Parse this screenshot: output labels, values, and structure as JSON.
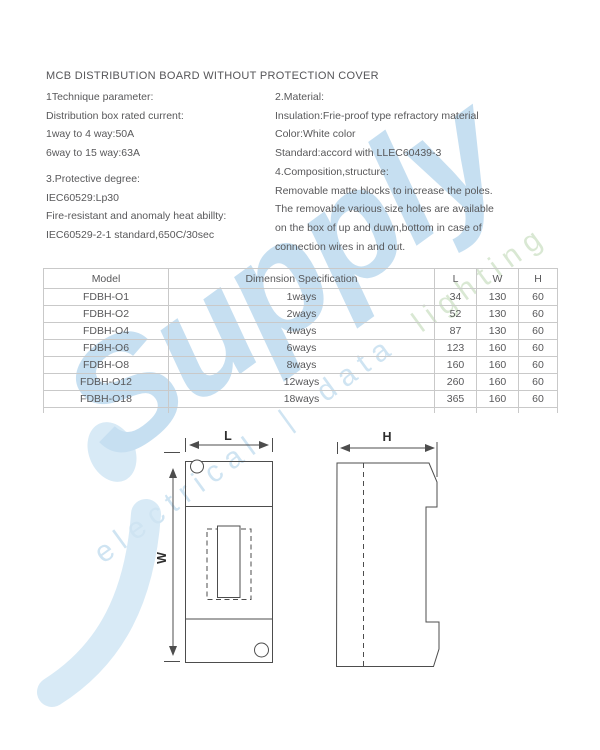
{
  "page": {
    "title": "MCB DISTRIBUTION BOARD WITHOUT PROTECTION COVER"
  },
  "sections": {
    "technique": {
      "heading": "1Technique parameter:",
      "lines": [
        "Distribution box rated current:",
        "1way to 4 way:50A",
        "6way to 15 way:63A"
      ]
    },
    "material": {
      "heading": "2.Material:",
      "lines": [
        "Insulation:Frie-proof type refractory material",
        "Color:White color",
        "Standard:accord with LLEC60439-3"
      ]
    },
    "protective": {
      "heading": "3.Protective degree:",
      "lines": [
        "IEC60529:Lp30",
        "Fire-resistant and anomaly heat abillty:",
        "IEC60529-2-1 standard,650C/30sec"
      ]
    },
    "composition": {
      "heading": "4.Composition,structure:",
      "lines": [
        "Removable matte blocks to increase the poles.",
        "The removable various size holes are available",
        "on the box of up and duwn,bottom in case of",
        "connection wires in and out."
      ]
    }
  },
  "table": {
    "headers": [
      "Model",
      "Dimension Specification",
      "L",
      "W",
      "H"
    ],
    "rows": [
      [
        "FDBH-O1",
        "1ways",
        "34",
        "130",
        "60"
      ],
      [
        "FDBH-O2",
        "2ways",
        "52",
        "130",
        "60"
      ],
      [
        "FDBH-O4",
        "4ways",
        "87",
        "130",
        "60"
      ],
      [
        "FDBH-O6",
        "6ways",
        "123",
        "160",
        "60"
      ],
      [
        "FDBH-O8",
        "8ways",
        "160",
        "160",
        "60"
      ],
      [
        "FDBH-O12",
        "12ways",
        "260",
        "160",
        "60"
      ],
      [
        "FDBH-O18",
        "18ways",
        "365",
        "160",
        "60"
      ]
    ]
  },
  "diagram": {
    "label_length": "L",
    "label_width": "W",
    "label_height": "H"
  },
  "watermark": {
    "brand": "Supply",
    "tagline_left": "electrical | data",
    "tagline_right": "lighting",
    "color_blue": "#c6dff1",
    "color_green": "#d9e8d3"
  }
}
